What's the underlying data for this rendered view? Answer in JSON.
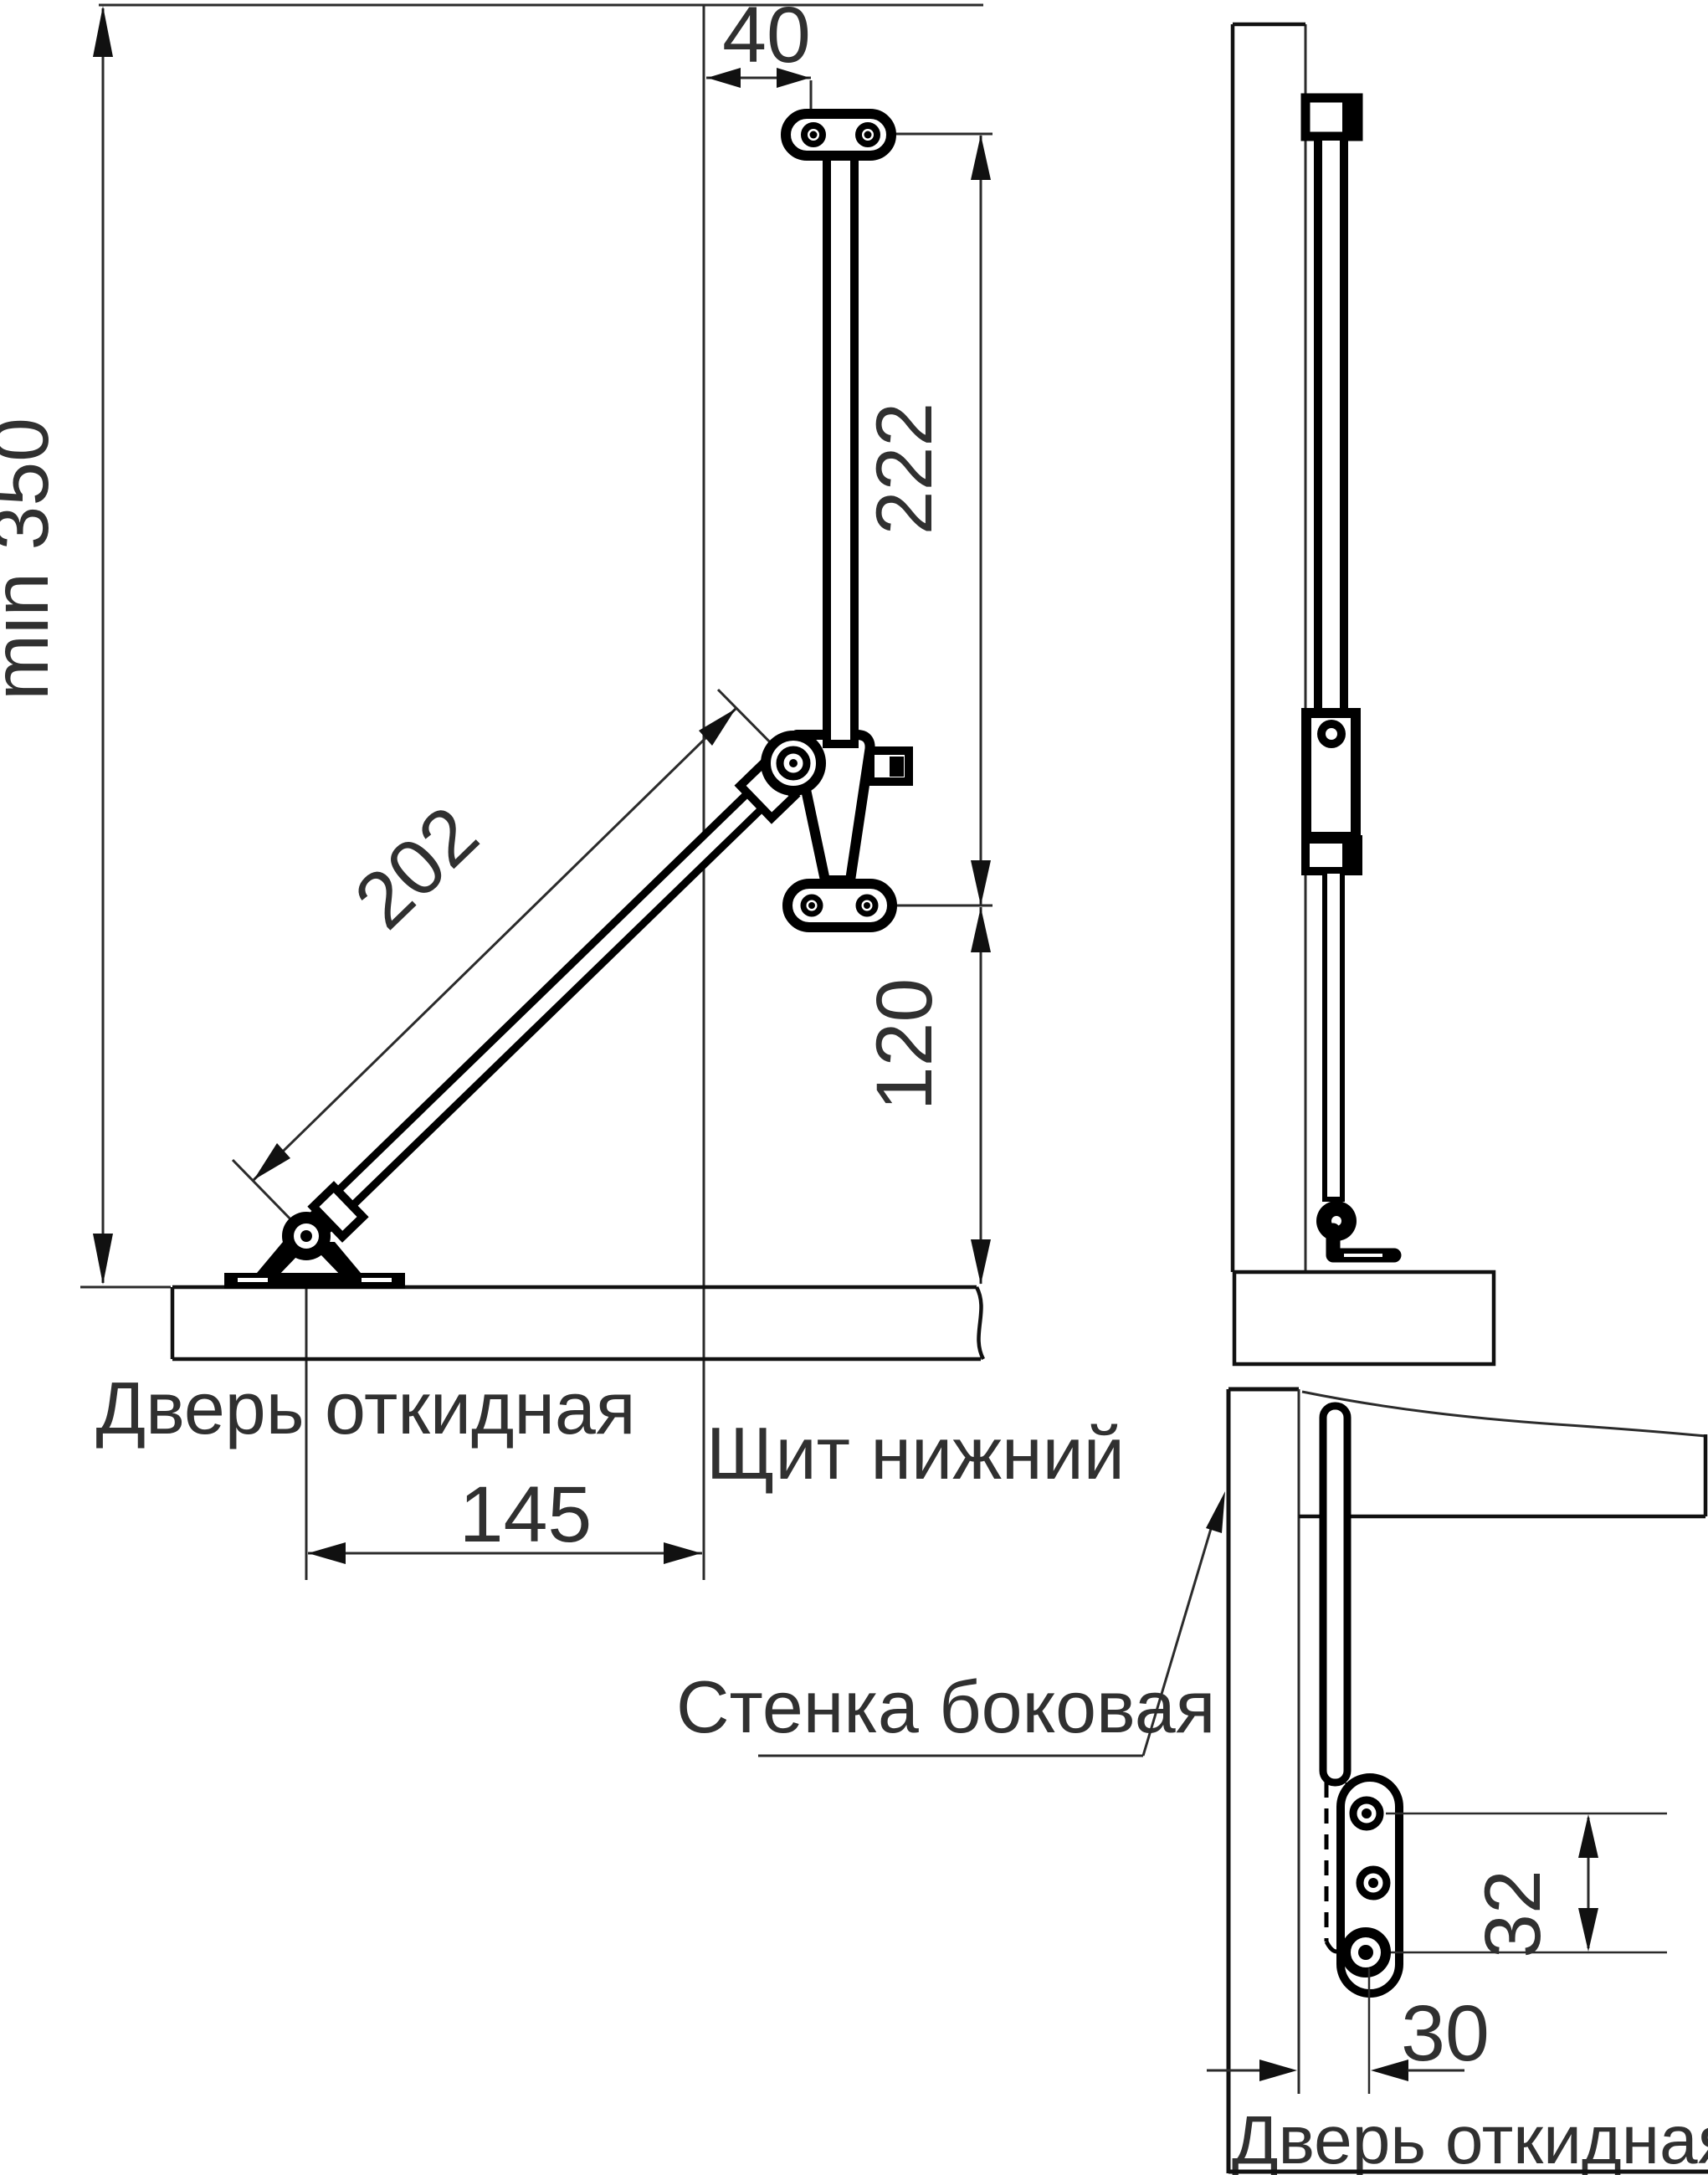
{
  "front_view": {
    "dim_min_height": "min 350",
    "dim_bracket_offset": "40",
    "dim_rod_length": "222",
    "dim_arm_length": "202",
    "dim_mid_to_door": "120",
    "dim_foot_offset": "145",
    "label_door": "Дверь откидная",
    "label_bottom_panel": "Щит нижний"
  },
  "bottom_view": {
    "dim_hole_spacing": "32",
    "dim_edge_to_hole": "30",
    "label_side_wall": "Стенка боковая",
    "label_door": "Дверь откидная"
  },
  "colors": {
    "ink": "#000000",
    "dim_line": "#2b2b2b",
    "text": "#303030",
    "background": "#ffffff"
  }
}
